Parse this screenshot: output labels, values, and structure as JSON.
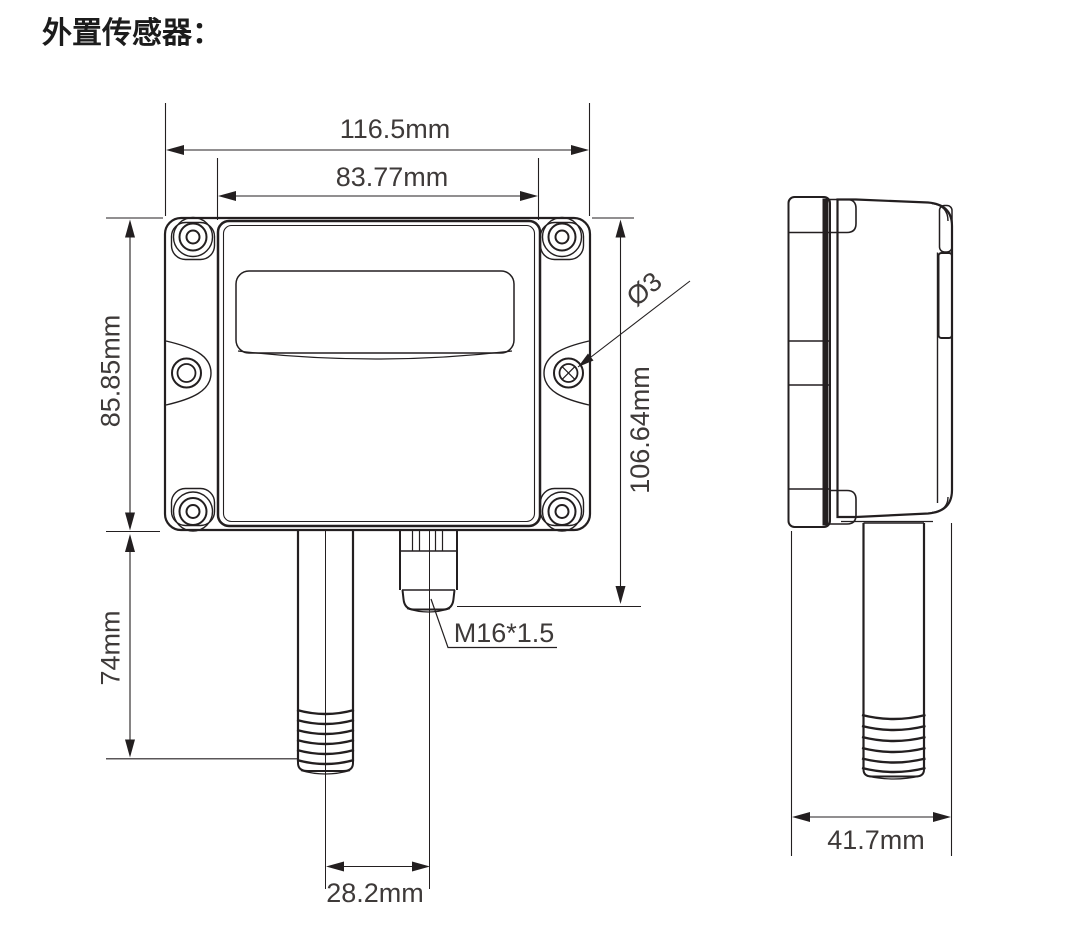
{
  "title": "外置传感器：",
  "colors": {
    "line": "#231f20",
    "text": "#3e3a39",
    "background": "#ffffff"
  },
  "front_view": {
    "dim_outer_width": "116.5mm",
    "dim_inner_width": "83.77mm",
    "dim_body_height": "85.85mm",
    "dim_probe_length": "74mm",
    "dim_overall_height": "106.64mm",
    "dim_hole_diameter": "Ø3",
    "dim_gland_thread": "M16*1.5",
    "dim_probe_to_gland": "28.2mm"
  },
  "side_view": {
    "dim_depth": "41.7mm"
  }
}
